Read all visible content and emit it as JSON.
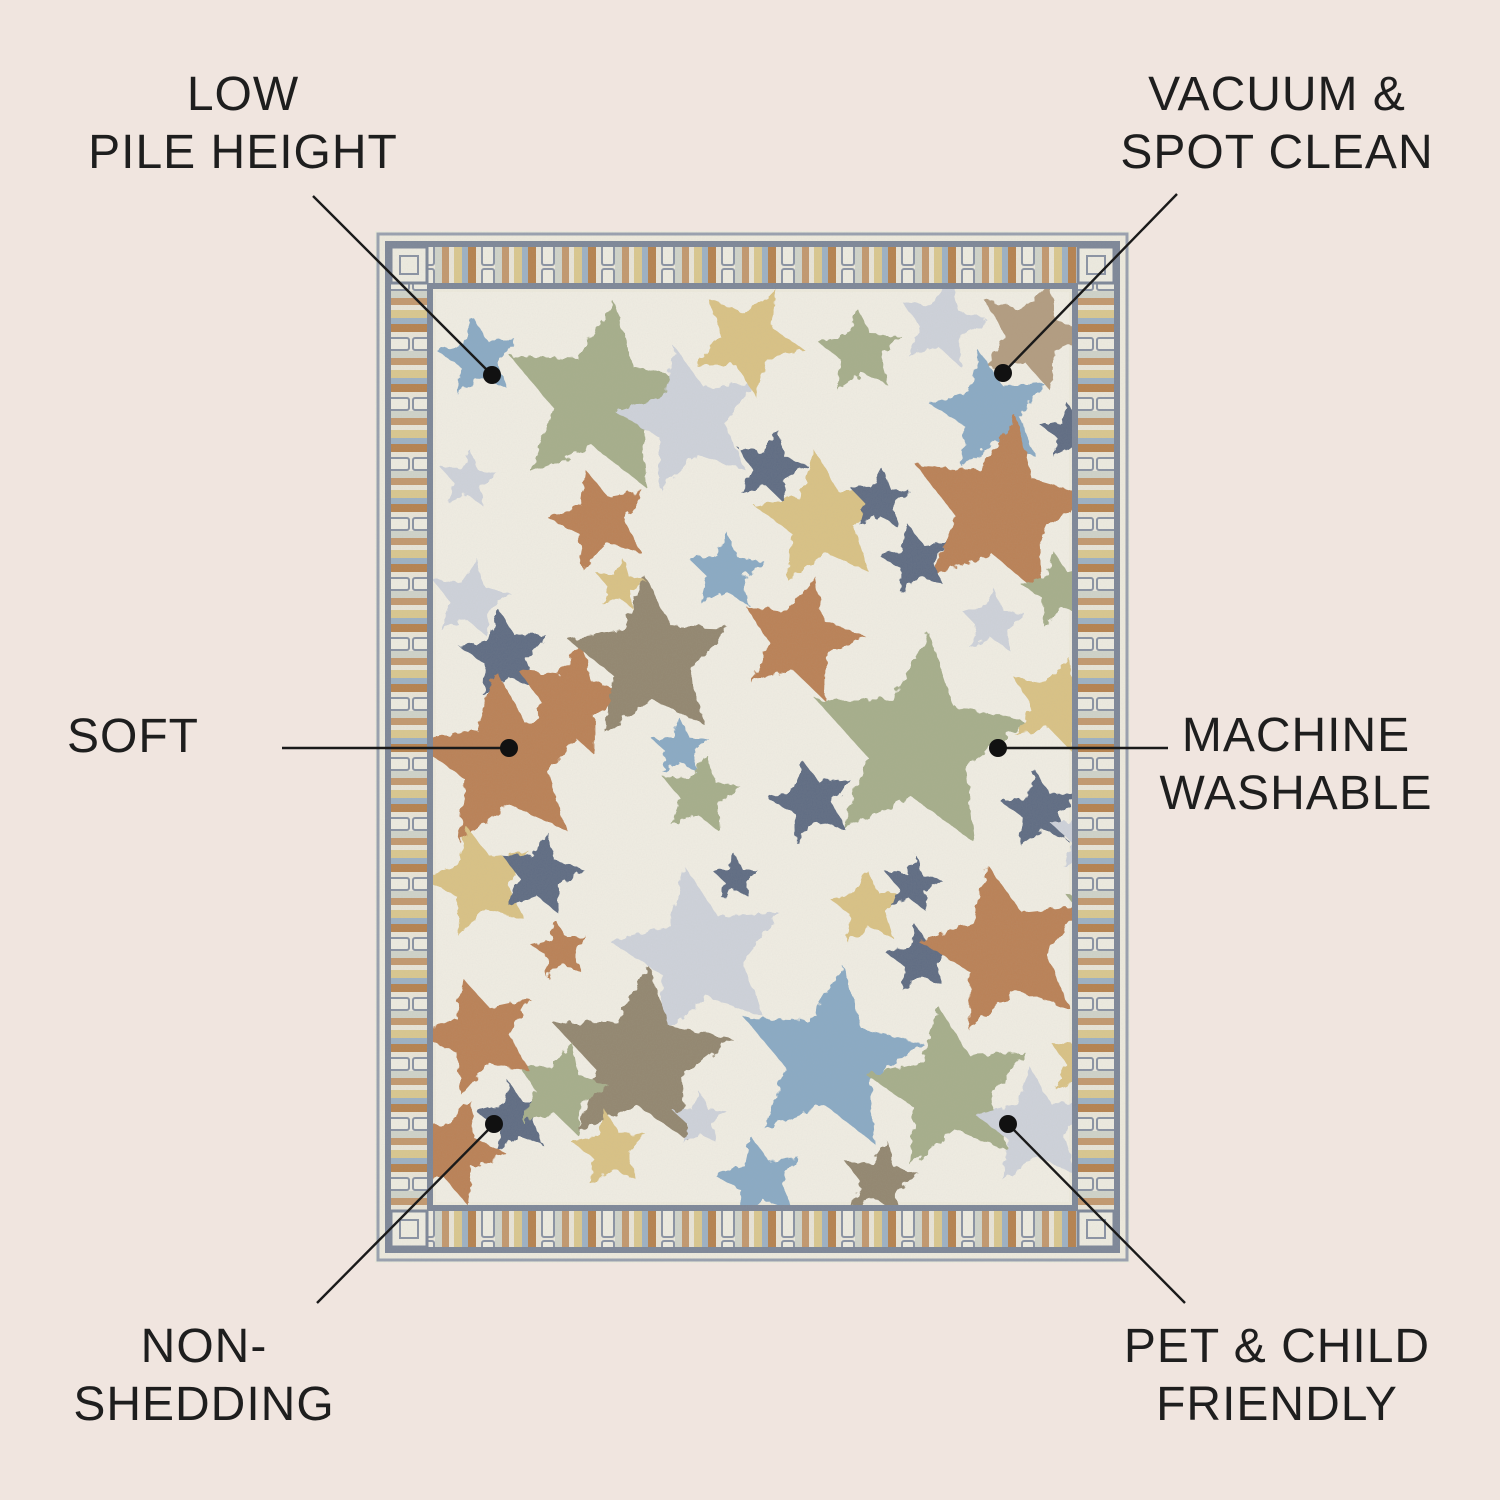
{
  "page": {
    "background_color": "#f0e5df",
    "text_color": "#1e1e1e",
    "line_color": "#1a1a1a",
    "dot_color": "#111111",
    "dot_radius": 9,
    "line_width": 2.4
  },
  "callouts": [
    {
      "id": "low-pile-height",
      "lines": [
        "LOW",
        "PILE HEIGHT"
      ],
      "label_center": {
        "x": 243,
        "y": 124
      },
      "line": {
        "x1": 313,
        "y1": 196,
        "x2": 492,
        "y2": 375
      },
      "dot": {
        "x": 492,
        "y": 375
      }
    },
    {
      "id": "vacuum-spot-clean",
      "lines": [
        "VACUUM &",
        "SPOT CLEAN"
      ],
      "label_center": {
        "x": 1277,
        "y": 124
      },
      "line": {
        "x1": 1177,
        "y1": 194,
        "x2": 1003,
        "y2": 373
      },
      "dot": {
        "x": 1003,
        "y": 373
      }
    },
    {
      "id": "soft",
      "lines": [
        "SOFT"
      ],
      "label_center": {
        "x": 133,
        "y": 737
      },
      "line": {
        "x1": 282,
        "y1": 748,
        "x2": 509,
        "y2": 748
      },
      "dot": {
        "x": 509,
        "y": 748
      }
    },
    {
      "id": "machine-washable",
      "lines": [
        "MACHINE",
        "WASHABLE"
      ],
      "label_center": {
        "x": 1296,
        "y": 765
      },
      "line": {
        "x1": 998,
        "y1": 748,
        "x2": 1168,
        "y2": 748
      },
      "dot": {
        "x": 998,
        "y": 748
      }
    },
    {
      "id": "non-shedding",
      "lines": [
        "NON-",
        "SHEDDING"
      ],
      "label_center": {
        "x": 204,
        "y": 1376
      },
      "line": {
        "x1": 317,
        "y1": 1303,
        "x2": 494,
        "y2": 1124
      },
      "dot": {
        "x": 494,
        "y": 1124
      }
    },
    {
      "id": "pet-child-friendly",
      "lines": [
        "PET & CHILD",
        "FRIENDLY"
      ],
      "label_center": {
        "x": 1277,
        "y": 1376
      },
      "line": {
        "x1": 1185,
        "y1": 1303,
        "x2": 1008,
        "y2": 1124
      },
      "dot": {
        "x": 1008,
        "y": 1124
      }
    }
  ],
  "rug": {
    "position": {
      "left": 375,
      "top": 231,
      "width": 755,
      "height": 1032
    },
    "colors": {
      "margin": "#edeadd",
      "field": "#f0ede3",
      "star_palette": {
        "blue": "#8aaac4",
        "sage": "#a6ae8b",
        "palegray": "#ced2da",
        "khaki": "#d9c285",
        "tan": "#b29c80",
        "navy": "#5e6c83",
        "rust": "#ba8156",
        "taupe": "#93876f"
      }
    },
    "border": {
      "rail_color": "#7d8798",
      "edge_line_color": "#98a0ae",
      "tile_bg": "#eae7db",
      "tie_fill": "#edebe0",
      "tie_stroke": "#8a93a3",
      "stripes": [
        [
          "#cfd3c9",
          7
        ],
        [
          "#c2986e",
          7
        ],
        [
          "#e8e4d7",
          5
        ],
        [
          "#d9c78f",
          8
        ],
        [
          "#9db1c3",
          6
        ],
        [
          "#b5824f",
          8
        ],
        [
          "#e8e4d7",
          5
        ]
      ],
      "tie_width": 14,
      "band_thickness": 36
    },
    "stars": [
      [
        103,
        127,
        42,
        "blue",
        -8
      ],
      [
        225,
        169,
        100,
        "sage",
        8
      ],
      [
        315,
        189,
        75,
        "palegray",
        -12
      ],
      [
        373,
        109,
        58,
        "khaki",
        28
      ],
      [
        485,
        121,
        44,
        "sage",
        -4
      ],
      [
        567,
        94,
        46,
        "palegray",
        12
      ],
      [
        657,
        104,
        58,
        "tan",
        18
      ],
      [
        615,
        181,
        62,
        "blue",
        -10
      ],
      [
        395,
        237,
        38,
        "navy",
        14
      ],
      [
        447,
        289,
        70,
        "khaki",
        -6
      ],
      [
        505,
        269,
        32,
        "navy",
        4
      ],
      [
        625,
        279,
        95,
        "rust",
        10
      ],
      [
        225,
        289,
        52,
        "rust",
        -16
      ],
      [
        93,
        249,
        30,
        "palegray",
        6
      ],
      [
        95,
        369,
        42,
        "palegray",
        10
      ],
      [
        130,
        424,
        46,
        "navy",
        -8
      ],
      [
        195,
        469,
        60,
        "rust",
        12
      ],
      [
        275,
        429,
        85,
        "taupe",
        -4
      ],
      [
        351,
        341,
        40,
        "blue",
        2
      ],
      [
        541,
        329,
        36,
        "navy",
        -12
      ],
      [
        425,
        409,
        65,
        "rust",
        14
      ],
      [
        543,
        514,
        112,
        "sage",
        6
      ],
      [
        617,
        391,
        34,
        "palegray",
        4
      ],
      [
        685,
        359,
        40,
        "sage",
        -10
      ],
      [
        130,
        531,
        92,
        "rust",
        -6
      ],
      [
        305,
        517,
        30,
        "blue",
        0
      ],
      [
        325,
        564,
        42,
        "sage",
        8
      ],
      [
        437,
        571,
        44,
        "navy",
        -14
      ],
      [
        680,
        474,
        50,
        "khaki",
        16
      ],
      [
        665,
        579,
        40,
        "navy",
        -6
      ],
      [
        713,
        604,
        40,
        "palegray",
        0
      ],
      [
        105,
        651,
        58,
        "khaki",
        -14
      ],
      [
        165,
        644,
        44,
        "navy",
        10
      ],
      [
        185,
        719,
        30,
        "rust",
        -8
      ],
      [
        325,
        724,
        90,
        "palegray",
        -10
      ],
      [
        265,
        829,
        95,
        "taupe",
        5
      ],
      [
        493,
        677,
        40,
        "khaki",
        -4
      ],
      [
        537,
        654,
        30,
        "navy",
        8
      ],
      [
        545,
        729,
        35,
        "navy",
        -6
      ],
      [
        630,
        719,
        88,
        "rust",
        -12
      ],
      [
        730,
        684,
        45,
        "sage",
        10
      ],
      [
        455,
        829,
        95,
        "blue",
        8
      ],
      [
        575,
        859,
        85,
        "sage",
        -8
      ],
      [
        140,
        887,
        38,
        "navy",
        -10
      ],
      [
        185,
        859,
        50,
        "sage",
        14
      ],
      [
        105,
        804,
        62,
        "rust",
        -18
      ],
      [
        77,
        921,
        55,
        "rust",
        20
      ],
      [
        235,
        919,
        40,
        "khaki",
        -6
      ],
      [
        325,
        889,
        28,
        "palegray",
        0
      ],
      [
        385,
        949,
        45,
        "blue",
        -12
      ],
      [
        505,
        949,
        40,
        "taupe",
        10
      ],
      [
        660,
        897,
        62,
        "palegray",
        -5
      ],
      [
        710,
        831,
        40,
        "khaki",
        12
      ],
      [
        360,
        647,
        24,
        "navy",
        0
      ],
      [
        695,
        201,
        30,
        "navy",
        -6
      ],
      [
        245,
        354,
        26,
        "khaki",
        8
      ]
    ]
  }
}
